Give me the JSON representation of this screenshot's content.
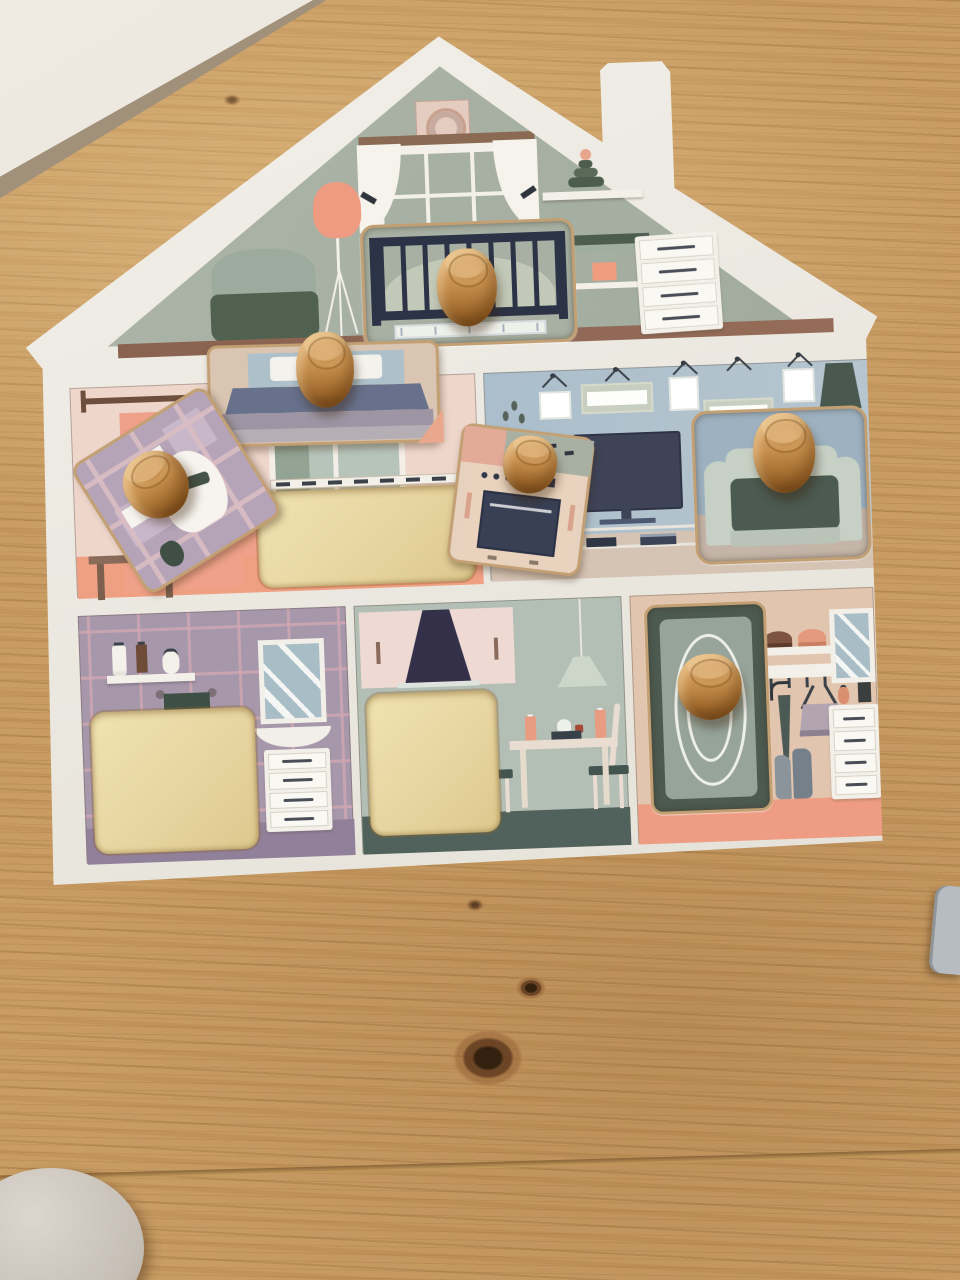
{
  "scene": {
    "title": "Wooden house-shaped toddler peg puzzle lying on a pine table",
    "setting": "photographed from above on a knotted pine wood surface, white wall visible in the top-left corner, round white object at bottom-left edge, corner of a grey puzzle piece at right edge",
    "board": {
      "label": "house silhouette puzzle board with chimney",
      "color": "white"
    },
    "rooms": [
      {
        "id": "attic",
        "label": "attic nursery with window, pink floor lamp, armchair, shelf toy, changing table and dresser"
      },
      {
        "id": "bedroom",
        "label": "bedroom with curtain rod, wardrobe, side table and empty bed slot"
      },
      {
        "id": "living",
        "label": "living room with five picture frames, plant, TV and floor lamp"
      },
      {
        "id": "bathroom",
        "label": "tiled bathroom with shelf, towel, mirror, sink vanity and empty toilet slot"
      },
      {
        "id": "kitchen",
        "label": "kitchen with extractor hood, pendant lamp, dining table and empty oven slot"
      },
      {
        "id": "hallway",
        "label": "hallway with hat shelf, coat hooks, umbrella, handbag, mirror, dresser and boots"
      }
    ],
    "pieces": [
      {
        "id": "crib",
        "label": "baby crib puzzle piece",
        "status": "in its slot (attic)"
      },
      {
        "id": "bed",
        "label": "bed puzzle piece",
        "status": "resting above its slot (bedroom)"
      },
      {
        "id": "toilet",
        "label": "toilet puzzle piece",
        "status": "loose, rotated (bedroom floor)"
      },
      {
        "id": "oven",
        "label": "oven puzzle piece",
        "status": "loose, rotated (between rooms)"
      },
      {
        "id": "armchair",
        "label": "armchair puzzle piece",
        "status": "in its slot (living room)"
      },
      {
        "id": "rug",
        "label": "oval rug puzzle piece",
        "status": "in its slot (hallway)"
      }
    ],
    "knob": {
      "label": "round wooden peg knob",
      "count_visible": 6
    },
    "empty_slots": {
      "label": "plywood cut-outs",
      "count_visible": 4
    },
    "palette": {
      "wood_table": "#c89c63",
      "board_white": "#edeae3",
      "attic_wall": "#a8b1a4",
      "attic_floor_strip": "#8a6250",
      "bedroom_wall": "#eed6cb",
      "salmon_accent": "#efa189",
      "living_wall": "#abbecb",
      "living_floor": "#d5c3b4",
      "bathroom_wall": "#a697ab",
      "bathroom_floor": "#91809a",
      "kitchen_wall": "#b3beb5",
      "kitchen_floor": "#51625c",
      "hallway_wall": "#e2c5ae",
      "hallway_floor": "#ee9d84",
      "plywood_cutout": "#ecdbaa",
      "knob_wood": "#c68f4e",
      "navy_crib": "#394055",
      "dark_green": "#4b5b51",
      "slate_blanket": "#67718c",
      "mauve_plaid": "#b5a4b7"
    }
  }
}
